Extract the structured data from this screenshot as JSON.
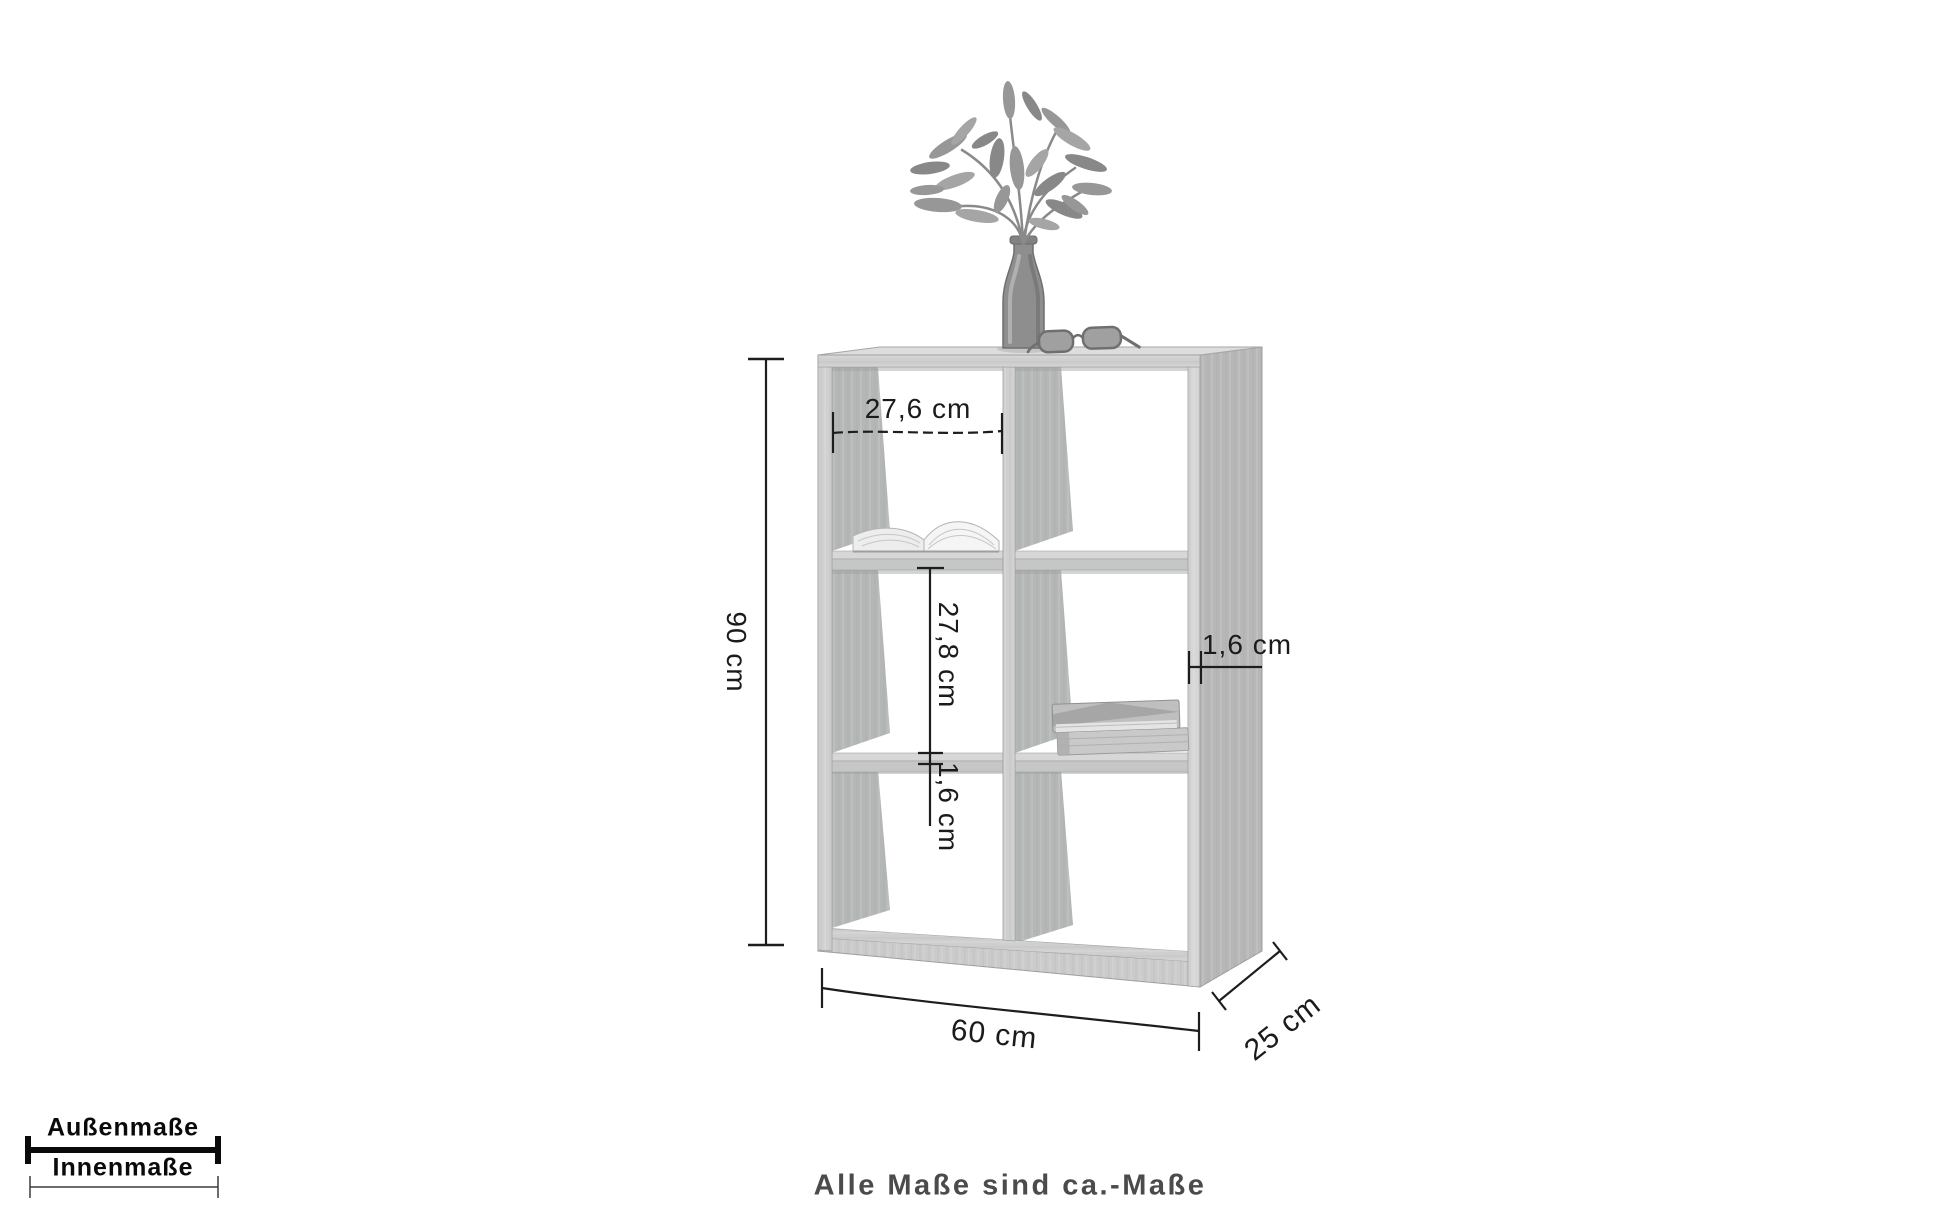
{
  "diagram": {
    "measurements": {
      "outer_height": "90 cm",
      "outer_width": "60 cm",
      "outer_depth": "25 cm",
      "inner_width": "27,6 cm",
      "inner_height": "27,8 cm",
      "shelf_thickness": "1,6 cm",
      "panel_thickness": "1,6 cm"
    },
    "legend": {
      "outer": "Außenmaße",
      "inner": "Innenmaße"
    },
    "footnote": "Alle Maße sind ca.-Maße",
    "colors": {
      "dimension_line": "#1d1d1d",
      "wood_front": "#cbcbcb",
      "wood_side": "#b7b7b7",
      "wood_inner": "#b4b7b6",
      "background": "#ffffff",
      "footnote_text": "#4b4b4b"
    }
  }
}
